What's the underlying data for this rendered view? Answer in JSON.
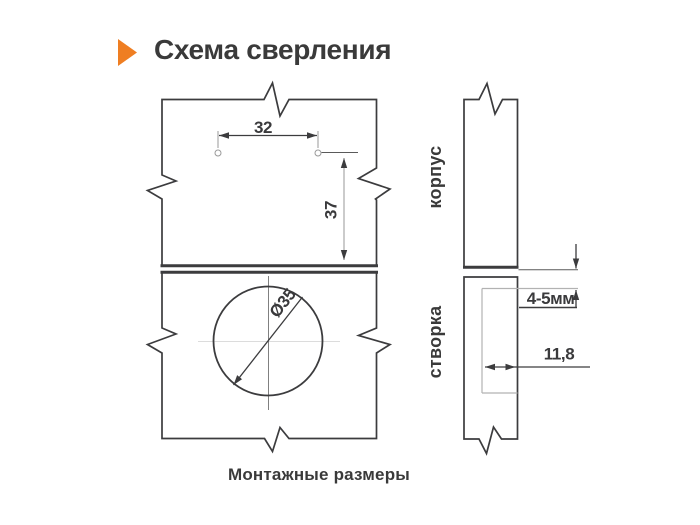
{
  "title": "Схема сверления",
  "caption": "Монтажные размеры",
  "front_view": {
    "hole_spacing": "32",
    "vertical_offset": "37",
    "cup_diameter": "Ø35"
  },
  "side_view": {
    "top_panel_label": "корпус",
    "bottom_panel_label": "створка",
    "edge_gap": "4-5мм",
    "cup_depth": "11,8"
  },
  "colors": {
    "accent_orange": "#EF7E22",
    "line_dark": "#3C3C3E",
    "line_light": "#B2B2B2"
  }
}
